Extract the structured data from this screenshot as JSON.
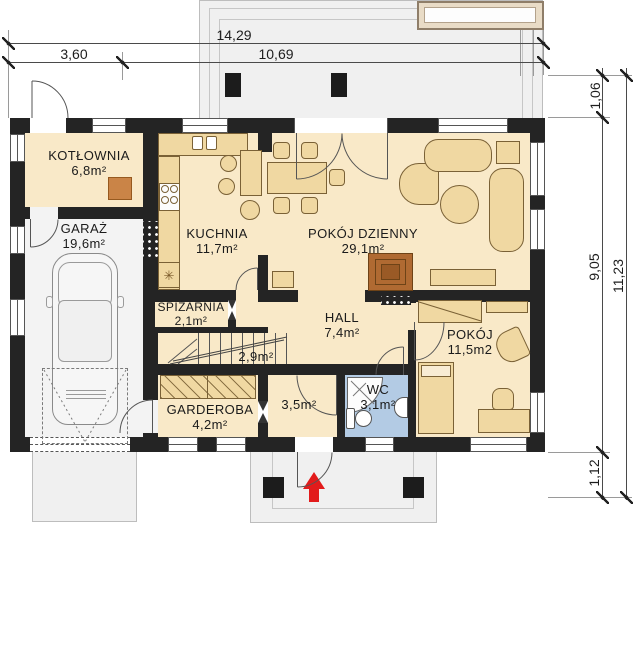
{
  "plan": {
    "title": "Rzut parteru",
    "rooms": {
      "kotlownia": {
        "name": "KOTŁOWNIA",
        "area": "6,8m²"
      },
      "garaz": {
        "name": "GARAŻ",
        "area": "19,6m²"
      },
      "kuchnia": {
        "name": "KUCHNIA",
        "area": "11,7m²"
      },
      "pokoj_dzienny": {
        "name": "POKÓJ DZIENNY",
        "area": "29,1m²"
      },
      "spizarnia": {
        "name": "SPIŻARNIA",
        "area": "2,1m²"
      },
      "schody": {
        "area": "2,9m²"
      },
      "hall": {
        "name": "HALL",
        "area": "7,4m²"
      },
      "pokoj": {
        "name": "POKÓJ",
        "area": "11,5m2"
      },
      "garderoba": {
        "name": "GARDEROBA",
        "area": "4,2m²"
      },
      "wiatrolap": {
        "area": "3,5m²"
      },
      "wc": {
        "name": "WC",
        "area": "3,1m²"
      }
    },
    "dimensions": {
      "top_total": "14,29",
      "top_seg_left": "3,60",
      "top_seg_right": "10,69",
      "right_upper": "1,06",
      "right_main": "9,05",
      "right_lower": "1,12",
      "right_total": "11,23"
    },
    "icons": {
      "freezer": "✳",
      "entry_arrow": "▲"
    },
    "colors": {
      "wall": "#242424",
      "floor": "#f9e9c8",
      "garage_floor": "#f3f3f3",
      "outdoor": "#f0f0f0",
      "wc_floor": "#b3cbe4",
      "furniture": "#f0d8a2",
      "furniture_border": "#7a6136",
      "boiler": "#ca8447",
      "fireplace": "#b06a32",
      "arrow": "#e21b1b",
      "awning": "#e9dcc7"
    }
  }
}
